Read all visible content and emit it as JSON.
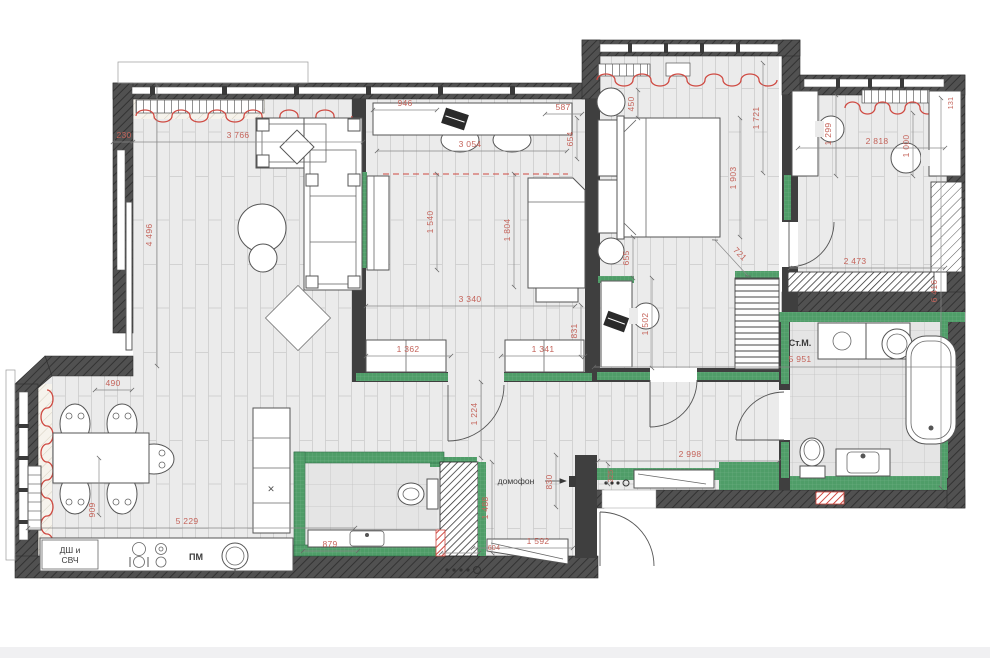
{
  "colors": {
    "wall": "#4f4f4f",
    "partition": "#3f3f3f",
    "tile_wall_green": "#4f9d68",
    "dimension_text_red": "#c4635a",
    "radiator_red": "#cf4a42",
    "floor_gray": "#ebebeb",
    "bath_tile_gray": "#e5e5e5"
  },
  "labels": {
    "oven_microwave_line1": "ДШ и",
    "oven_microwave_line2": "СВЧ",
    "dishwasher": "ПМ",
    "intercom": "домофон",
    "washing_machine": "Ст.М.",
    "cabinet_mark": "✕"
  },
  "dims": {
    "wall_230": "230",
    "living_width": "3 766",
    "living_height": "4 496",
    "desk_946": "946",
    "child_top_width": "3 054",
    "child_587": "587",
    "child_654": "654",
    "wardrobe_1540": "1 540",
    "child_bed_1804": "1 804",
    "child_width": "3 340",
    "cabinet_left_1362": "1 362",
    "cabinet_right_1341": "1 341",
    "child_831": "831",
    "bed_gap_450": "450",
    "bedroom_1721": "1 721",
    "bed_length_1903": "1 903",
    "bed_diag_721": "721",
    "bed_655": "655",
    "desk_zone_1502": "1 502",
    "office_1299": "1 299",
    "office_width_2818": "2 818",
    "office_1000": "1 000",
    "office_bottom_2473": "2 473",
    "right_wing_6416": "6 416",
    "note_131": "131",
    "bath_width_5951": "5 951",
    "hall_width_2998": "2 998",
    "hall_1224": "1 224",
    "hall_325": "325",
    "hall_830": "830",
    "hall_1488": "1 488",
    "hall_1592": "1 592",
    "hall_604": "604",
    "wc_879": "879",
    "kitchen_width_5229": "5 229",
    "kitchen_909": "909",
    "kitchen_490": "490"
  }
}
